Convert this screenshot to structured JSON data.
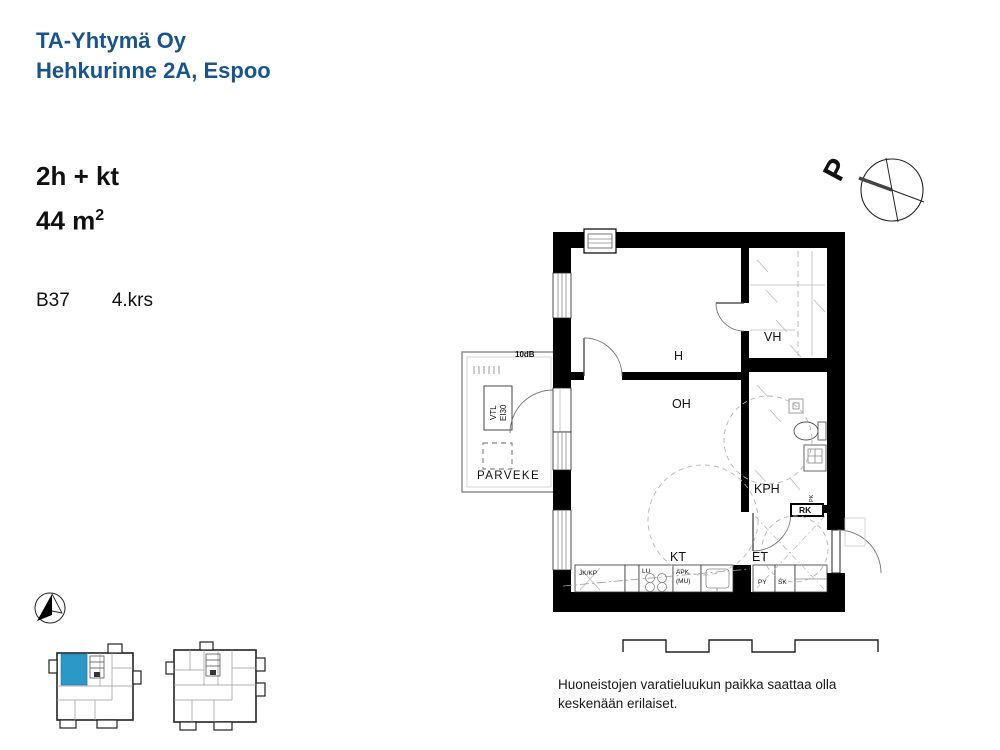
{
  "header": {
    "company": "TA-Yhtymä Oy",
    "address": "Hehkurinne 2A, Espoo"
  },
  "apartment": {
    "type": "2h + kt",
    "area": "44 m",
    "area_sup": "2",
    "unit": "B37",
    "floor": "4.krs"
  },
  "compass": {
    "north": "P"
  },
  "plan": {
    "rooms": {
      "h": "H",
      "oh": "OH",
      "vh": "VH",
      "kph": "KPH",
      "kt": "KT",
      "et": "ET"
    },
    "balcony": {
      "name": "PARVEKE",
      "vtl": "VTL",
      "ei30": "EI30",
      "sound": "10dB"
    },
    "labels": {
      "jkkp": "JK/KP",
      "lu": "LU",
      "apk": "APK",
      "mu": "(MU)",
      "py": "PY",
      "sk": "SK",
      "rk": "RK",
      "pk": "PK"
    }
  },
  "footnote": {
    "line1": "Huoneistojen varatieluukun paikka saattaa olla",
    "line2": "keskenään erilaiset."
  },
  "colors": {
    "brand_blue": "#19548F",
    "unit_blue": "#2B98C8",
    "line_black": "#000000"
  }
}
